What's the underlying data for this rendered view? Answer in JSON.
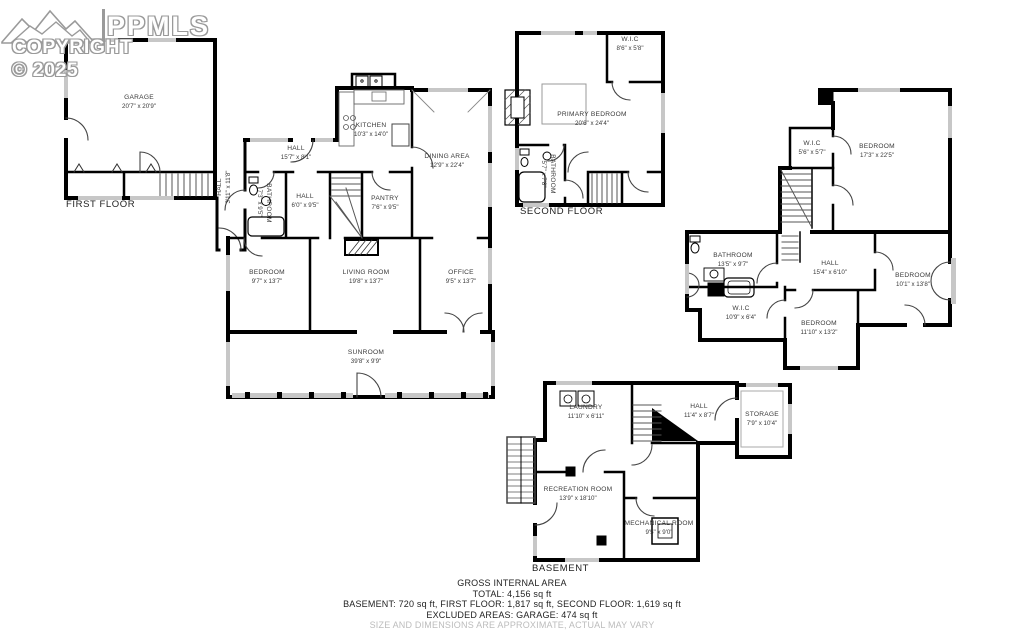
{
  "logo": {
    "brand": "PPMLS",
    "copyright": "COPYRIGHT © 2025"
  },
  "floors": {
    "first": {
      "label": "FIRST FLOOR",
      "rooms": [
        {
          "name": "GARAGE",
          "dims": "20'7\" x 20'9\""
        },
        {
          "name": "HALL",
          "dims": "15'7\" x 8'1\""
        },
        {
          "name": "KITCHEN",
          "dims": "10'3\" x 14'0\""
        },
        {
          "name": "DINING AREA",
          "dims": "12'9\" x 22'4\""
        },
        {
          "name": "HALL",
          "dims": "3'11\" x 11'8\""
        },
        {
          "name": "BATHROOM",
          "dims": "7'3\" x 9'5\""
        },
        {
          "name": "HALL",
          "dims": "6'0\" x 9'5\""
        },
        {
          "name": "PANTRY",
          "dims": "7'6\" x 9'5\""
        },
        {
          "name": "BEDROOM",
          "dims": "9'7\" x 13'7\""
        },
        {
          "name": "LIVING ROOM",
          "dims": "19'8\" x 13'7\""
        },
        {
          "name": "OFFICE",
          "dims": "9'5\" x 13'7\""
        },
        {
          "name": "SUNROOM",
          "dims": "39'8\" x 9'9\""
        }
      ]
    },
    "second": {
      "label": "SECOND FLOOR",
      "rooms": [
        {
          "name": "W.I.C",
          "dims": "8'6\" x 5'8\""
        },
        {
          "name": "PRIMARY BEDROOM",
          "dims": "20'6\" x 24'4\""
        },
        {
          "name": "BATHROOM",
          "dims": "5'7\" x 7'8\""
        },
        {
          "name": "W.I.C",
          "dims": "5'6\" x 5'7\""
        },
        {
          "name": "BEDROOM",
          "dims": "17'3\" x 22'5\""
        },
        {
          "name": "BATHROOM",
          "dims": "13'5\" x 9'7\""
        },
        {
          "name": "HALL",
          "dims": "15'4\" x 6'10\""
        },
        {
          "name": "W.I.C",
          "dims": "10'9\" x 6'4\""
        },
        {
          "name": "BEDROOM",
          "dims": "10'1\" x 13'8\""
        },
        {
          "name": "BEDROOM",
          "dims": "11'10\" x 13'2\""
        }
      ]
    },
    "basement": {
      "label": "BASEMENT",
      "rooms": [
        {
          "name": "LAUNDRY",
          "dims": "11'10\" x 6'11\""
        },
        {
          "name": "HALL",
          "dims": "11'4\" x 8'7\""
        },
        {
          "name": "STORAGE",
          "dims": "7'9\" x 10'4\""
        },
        {
          "name": "RECREATION ROOM",
          "dims": "13'9\" x 18'10\""
        },
        {
          "name": "MECHANICAL ROOM",
          "dims": "9'5\" x 9'0\""
        }
      ]
    }
  },
  "summary": {
    "title": "GROSS INTERNAL AREA",
    "total": "TOTAL: 4,156 sq ft",
    "breakdown": "BASEMENT: 720 sq ft, FIRST FLOOR: 1,817 sq ft, SECOND FLOOR: 1,619 sq ft",
    "excluded": "EXCLUDED AREAS: GARAGE: 474 sq ft",
    "disclaimer": "SIZE AND DIMENSIONS ARE APPROXIMATE, ACTUAL MAY VARY"
  },
  "colors": {
    "wall": "#000000",
    "window": "#c7c7c7",
    "label_text": "#3a3a3a",
    "disclaimer_text": "#bcbcbc",
    "logo_outline": "#9a9a9a"
  }
}
